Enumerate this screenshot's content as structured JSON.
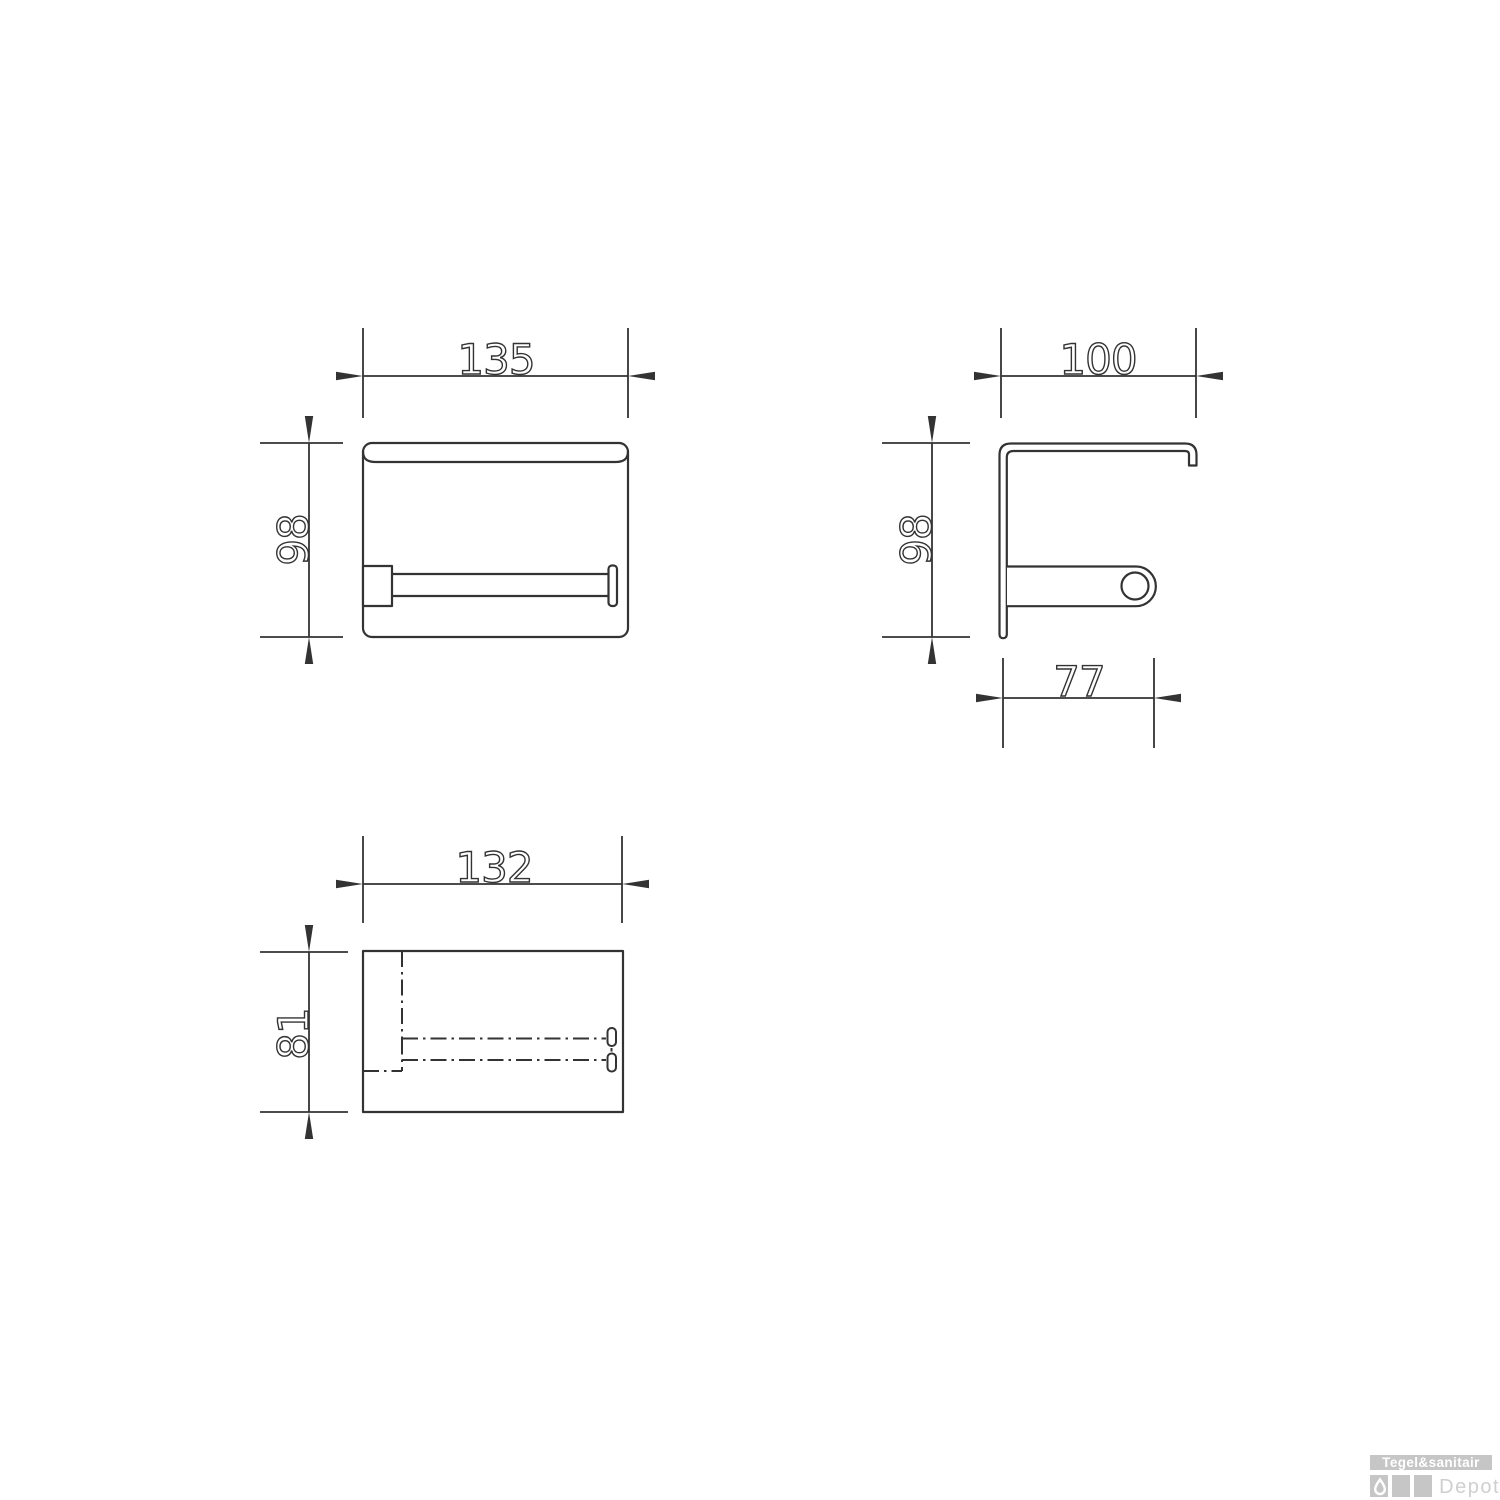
{
  "drawing": {
    "front_view": {
      "width": "135",
      "height": "98"
    },
    "side_view": {
      "width": "100",
      "height": "98",
      "roller_depth": "77"
    },
    "top_view": {
      "width": "132",
      "depth": "81"
    }
  },
  "logo": {
    "brand": "Tegel&sanitair",
    "sub": "Depot"
  },
  "colors": {
    "line": "#333333",
    "logo_gray": "#c6c6c6",
    "logo_brand_text": "#ffffff",
    "logo_sub_text": "#cfcfcf",
    "background": "#ffffff"
  }
}
